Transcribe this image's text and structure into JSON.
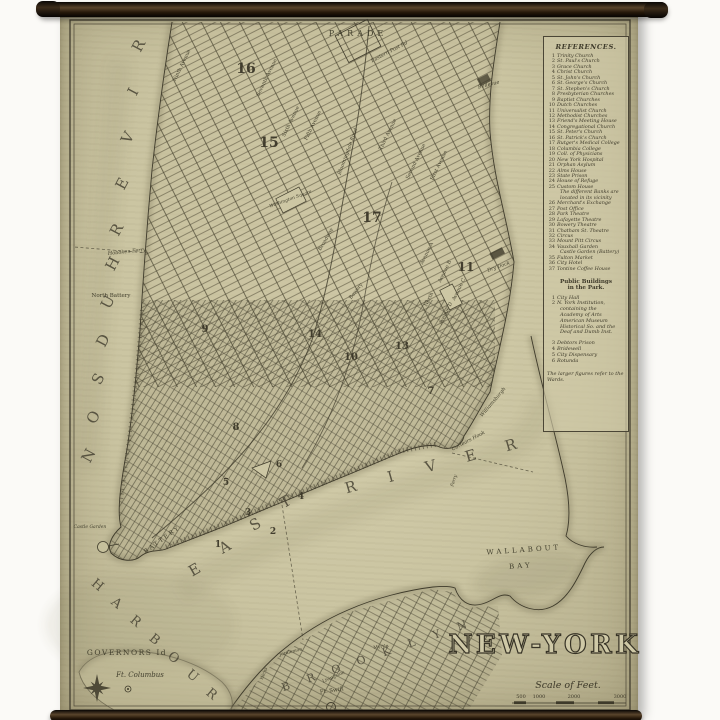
{
  "scene": {
    "background": "#fbfaf7",
    "description": "antique wall-hanging map on rods"
  },
  "rods": {
    "dark": "#17110b",
    "mid": "#574230"
  },
  "paper": {
    "base": "#cac4a1",
    "light": "#d6d0ae",
    "edge": "#b2ab89",
    "ink": "#45412f"
  },
  "map": {
    "title": "NEW-YORK",
    "scale": {
      "label": "Scale of Feet.",
      "ticks": [
        "500",
        "1000",
        "2000",
        "3000"
      ]
    },
    "labels": [
      {
        "t": "PARADE",
        "x": 358,
        "y": 36,
        "r": 0,
        "s": 8,
        "ls": 4
      },
      {
        "t": "Eastern Post Rd",
        "x": 390,
        "y": 53,
        "r": -28,
        "s": 5,
        "it": 1
      },
      {
        "t": "Bellevue",
        "x": 489,
        "y": 86,
        "r": -14,
        "s": 5,
        "it": 1
      },
      {
        "t": "Ninth Avenue",
        "x": 183,
        "y": 66,
        "r": -64,
        "s": 5
      },
      {
        "t": "Seventh Avenue",
        "x": 268,
        "y": 78,
        "r": -64,
        "s": 5
      },
      {
        "t": "Sixth Avenue",
        "x": 292,
        "y": 122,
        "r": -64,
        "s": 5
      },
      {
        "t": "Fifth Avenue",
        "x": 314,
        "y": 126,
        "r": -64,
        "s": 5
      },
      {
        "t": "Bloomingdale Road",
        "x": 349,
        "y": 152,
        "r": -70,
        "s": 5,
        "it": 1
      },
      {
        "t": "Third Avenue",
        "x": 389,
        "y": 135,
        "r": -64,
        "s": 5
      },
      {
        "t": "Second Avenue",
        "x": 417,
        "y": 162,
        "r": -64,
        "s": 5
      },
      {
        "t": "First Avenue",
        "x": 440,
        "y": 166,
        "r": -64,
        "s": 5
      },
      {
        "t": "Avenue A",
        "x": 428,
        "y": 254,
        "r": -64,
        "s": 5
      },
      {
        "t": "Avenue B",
        "x": 446,
        "y": 272,
        "r": -64,
        "s": 5
      },
      {
        "t": "Avenue C",
        "x": 460,
        "y": 290,
        "r": -64,
        "s": 5
      },
      {
        "t": "Avenue D",
        "x": 447,
        "y": 314,
        "r": -64,
        "s": 5
      },
      {
        "t": "North",
        "x": 430,
        "y": 300,
        "r": -64,
        "s": 5
      },
      {
        "t": "Bowery",
        "x": 357,
        "y": 292,
        "r": -52,
        "s": 5
      },
      {
        "t": "Broadway",
        "x": 327,
        "y": 240,
        "r": -60,
        "s": 5
      },
      {
        "t": "Washington Square",
        "x": 291,
        "y": 200,
        "r": -20,
        "s": 4.5,
        "it": 1
      },
      {
        "t": "Dry Dock",
        "x": 499,
        "y": 268,
        "r": -20,
        "s": 5,
        "it": 1
      },
      {
        "t": "Hoboken Ferry",
        "x": 127,
        "y": 253,
        "r": -6,
        "s": 5,
        "it": 1
      },
      {
        "t": "North Battery",
        "x": 111,
        "y": 297,
        "r": 0,
        "s": 5.5
      },
      {
        "t": "Castle Garden",
        "x": 90,
        "y": 528,
        "r": 0,
        "s": 4.5,
        "it": 1
      },
      {
        "t": "BATTERY",
        "x": 163,
        "y": 541,
        "r": -36,
        "s": 6,
        "ls": 2
      },
      {
        "t": "Corlears Hook",
        "x": 469,
        "y": 442,
        "r": -28,
        "s": 5,
        "it": 1
      },
      {
        "t": "Ferry",
        "x": 455,
        "y": 481,
        "r": -72,
        "s": 4.5,
        "it": 1
      },
      {
        "t": "Williamsburgh",
        "x": 494,
        "y": 403,
        "r": -50,
        "s": 5,
        "it": 1
      },
      {
        "t": "WALLABOUT",
        "x": 524,
        "y": 552,
        "r": -4,
        "s": 7,
        "ls": 3
      },
      {
        "t": "BAY",
        "x": 521,
        "y": 568,
        "r": -4,
        "s": 7,
        "ls": 3
      },
      {
        "t": "GOVERNORS Id",
        "x": 127,
        "y": 655,
        "r": 0,
        "s": 7.5,
        "ls": 1.5
      },
      {
        "t": "Ft. Columbus",
        "x": 140,
        "y": 677,
        "r": 0,
        "s": 7,
        "it": 1
      },
      {
        "t": "Joralemon",
        "x": 291,
        "y": 653,
        "r": -14,
        "s": 4.5
      },
      {
        "t": "Myrtle",
        "x": 381,
        "y": 648,
        "r": -8,
        "s": 4.5
      },
      {
        "t": "Hicks",
        "x": 265,
        "y": 674,
        "r": -68,
        "s": 4.5
      },
      {
        "t": "Livingston",
        "x": 334,
        "y": 678,
        "r": -24,
        "s": 4.5
      },
      {
        "t": "Ft. Swift",
        "x": 332,
        "y": 692,
        "r": -8,
        "s": 5.5
      },
      {
        "t": "RIVER",
        "mode": "spread",
        "x": 143,
        "y": 48,
        "x2": 121,
        "y2": 232,
        "r": -62,
        "s": 15
      },
      {
        "t": "HUDSON",
        "mode": "spread",
        "x": 117,
        "y": 266,
        "x2": 93,
        "y2": 458,
        "r": -62,
        "s": 15
      },
      {
        "t": "EAST",
        "mode": "spread",
        "x": 197,
        "y": 574,
        "x2": 288,
        "y2": 506,
        "r": -30,
        "s": 15
      },
      {
        "t": "RIVER",
        "mode": "spread",
        "x": 352,
        "y": 492,
        "x2": 512,
        "y2": 450,
        "r": -16,
        "s": 15
      },
      {
        "t": "HARBOUR",
        "mode": "spread",
        "x": 95,
        "y": 588,
        "x2": 209,
        "y2": 697,
        "r": 40,
        "s": 13
      },
      {
        "t": "BROOKLYN",
        "mode": "spread",
        "x": 287,
        "y": 690,
        "x2": 463,
        "y2": 629,
        "r": -20,
        "s": 11
      }
    ],
    "wards": [
      {
        "n": "16",
        "x": 246,
        "y": 73,
        "s": 14
      },
      {
        "n": "15",
        "x": 269,
        "y": 147,
        "s": 14
      },
      {
        "n": "17",
        "x": 372,
        "y": 222,
        "s": 14
      },
      {
        "n": "11",
        "x": 466,
        "y": 271,
        "s": 12
      },
      {
        "n": "9",
        "x": 205,
        "y": 332,
        "s": 10
      },
      {
        "n": "14",
        "x": 315,
        "y": 337,
        "s": 10
      },
      {
        "n": "10",
        "x": 351,
        "y": 360,
        "s": 10
      },
      {
        "n": "13",
        "x": 402,
        "y": 349,
        "s": 10
      },
      {
        "n": "7",
        "x": 431,
        "y": 394,
        "s": 10
      },
      {
        "n": "8",
        "x": 236,
        "y": 430,
        "s": 10
      },
      {
        "n": "6",
        "x": 279,
        "y": 467,
        "s": 9
      },
      {
        "n": "5",
        "x": 226,
        "y": 485,
        "s": 9
      },
      {
        "n": "4",
        "x": 301,
        "y": 499,
        "s": 9
      },
      {
        "n": "3",
        "x": 248,
        "y": 515,
        "s": 9
      },
      {
        "n": "2",
        "x": 273,
        "y": 534,
        "s": 9
      },
      {
        "n": "1",
        "x": 218,
        "y": 547,
        "s": 9
      }
    ]
  },
  "references": {
    "title": "REFERENCES.",
    "items": [
      {
        "n": "1",
        "t": "Trinity Church"
      },
      {
        "n": "2",
        "t": "St. Paul's Church"
      },
      {
        "n": "3",
        "t": "Grace Church"
      },
      {
        "n": "4",
        "t": "Christ Church"
      },
      {
        "n": "5",
        "t": "St. John's Church"
      },
      {
        "n": "6",
        "t": "St. George's Church"
      },
      {
        "n": "7",
        "t": "St. Stephen's Church"
      },
      {
        "n": "8",
        "t": "Presbyterian Churches"
      },
      {
        "n": "9",
        "t": "Baptist Churches"
      },
      {
        "n": "10",
        "t": "Dutch Churches"
      },
      {
        "n": "11",
        "t": "Universalist Church"
      },
      {
        "n": "12",
        "t": "Methodist Churches"
      },
      {
        "n": "13",
        "t": "Friend's Meeting House"
      },
      {
        "n": "14",
        "t": "Congregational Church"
      },
      {
        "n": "15",
        "t": "St. Peter's Church"
      },
      {
        "n": "16",
        "t": "St. Patrick's Church"
      },
      {
        "n": "17",
        "t": "Rutger's Medical College"
      },
      {
        "n": "18",
        "t": "Columbia College"
      },
      {
        "n": "19",
        "t": "Coll. of Physicians"
      },
      {
        "n": "20",
        "t": "New York Hospital"
      },
      {
        "n": "21",
        "t": "Orphan Asylum"
      },
      {
        "n": "22",
        "t": "Alms House"
      },
      {
        "n": "23",
        "t": "State Prison"
      },
      {
        "n": "24",
        "t": "House of Refuge"
      },
      {
        "n": "25",
        "t": "Custom House"
      },
      {
        "n": "",
        "t": "The different Banks are"
      },
      {
        "n": "",
        "t": "located in its vicinity"
      },
      {
        "n": "26",
        "t": "Merchant's Exchange"
      },
      {
        "n": "27",
        "t": "Post Office"
      },
      {
        "n": "28",
        "t": "Park Theatre"
      },
      {
        "n": "29",
        "t": "Lafayette Theatre"
      },
      {
        "n": "30",
        "t": "Bowery Theatre"
      },
      {
        "n": "31",
        "t": "Chatham St. Theatre"
      },
      {
        "n": "32",
        "t": "Circus"
      },
      {
        "n": "33",
        "t": "Mount Pitt Circus"
      },
      {
        "n": "34",
        "t": "Vauxhall Garden"
      },
      {
        "n": "",
        "t": "Castle Garden (Battery)"
      },
      {
        "n": "35",
        "t": "Fulton Market"
      },
      {
        "n": "36",
        "t": "City Hotel"
      },
      {
        "n": "37",
        "t": "Tontine Coffee House"
      }
    ],
    "park_heading": [
      "Public Buildings",
      "in the Park."
    ],
    "park_items": [
      {
        "n": "1",
        "t": "City Hall"
      },
      {
        "n": "2",
        "t": "N. York Institution,"
      },
      {
        "n": "",
        "t": "containing the"
      },
      {
        "n": "",
        "t": "Academy of Arts"
      },
      {
        "n": "",
        "t": "American Museum"
      },
      {
        "n": "",
        "t": "Historical So. and the"
      },
      {
        "n": "",
        "t": "Deaf and Dumb Inst."
      },
      {
        "n": "3",
        "t": "Debtors Prison",
        "gap": 1
      },
      {
        "n": "4",
        "t": "Bridewell"
      },
      {
        "n": "5",
        "t": "City Dispensary"
      },
      {
        "n": "6",
        "t": "Rotunda"
      }
    ],
    "footnote": "The larger figures refer to the Wards."
  }
}
